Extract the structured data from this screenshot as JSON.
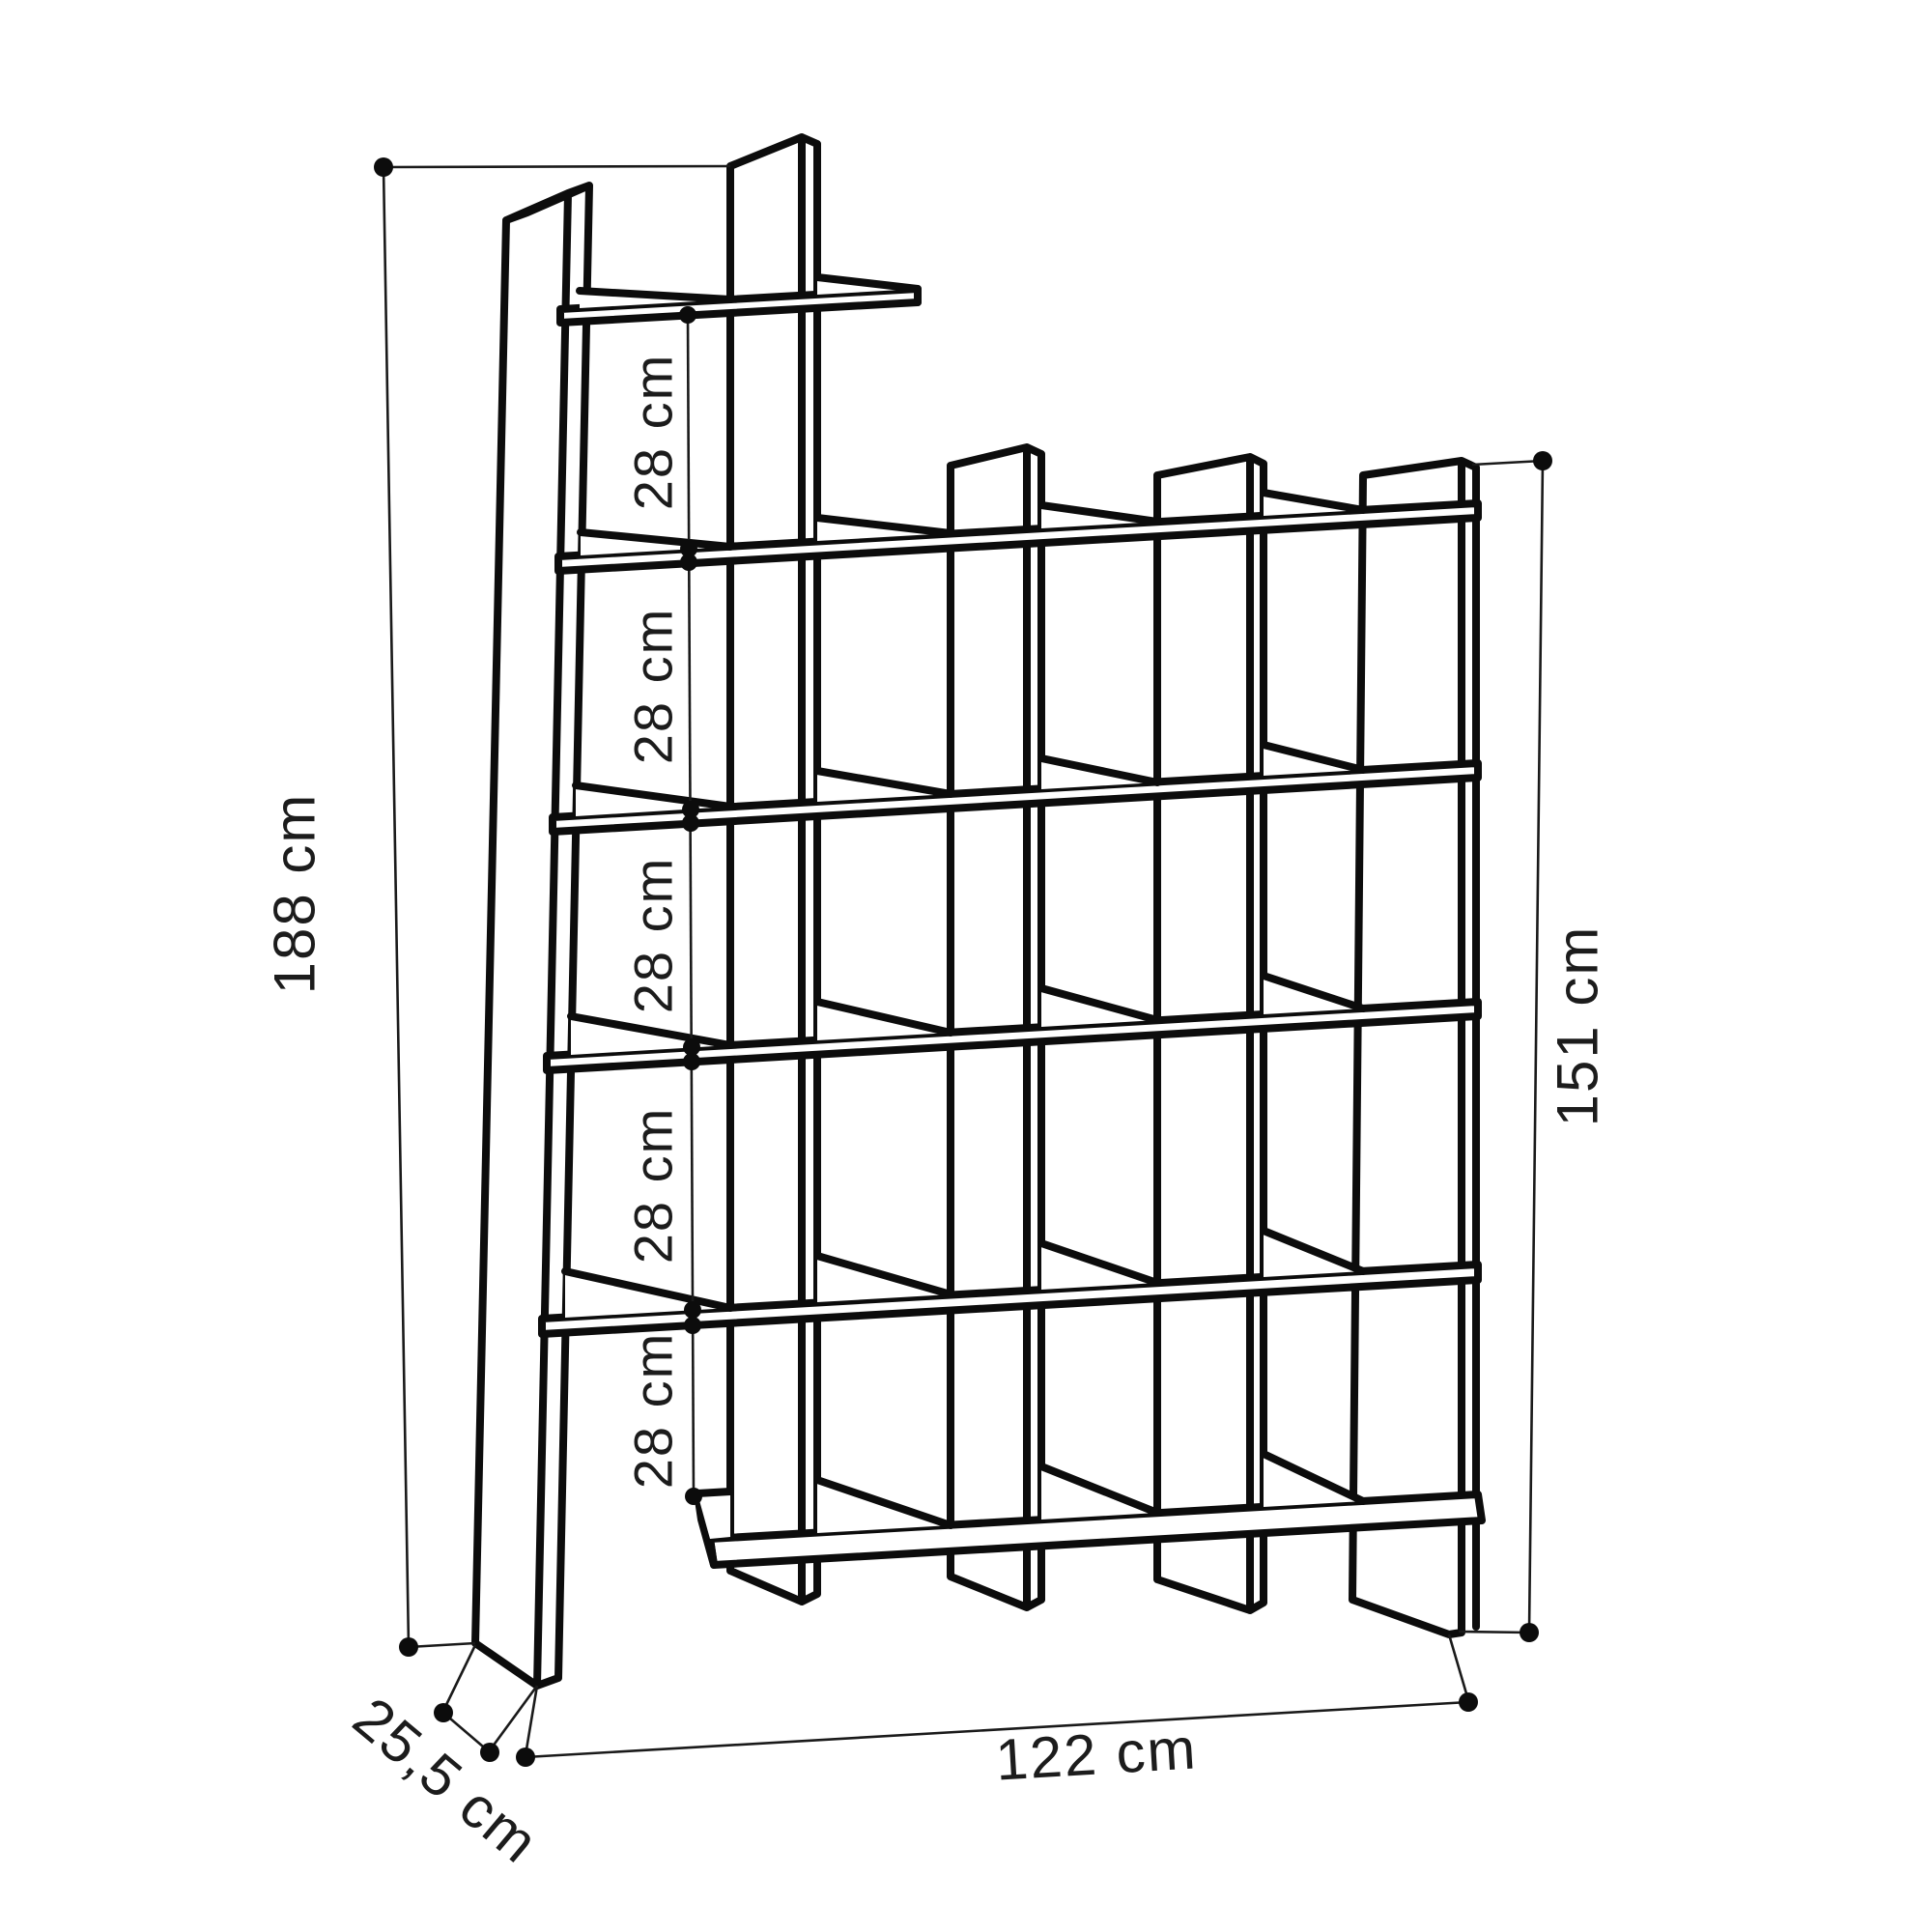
{
  "dimensions": {
    "total_height": "188 cm",
    "right_height": "151 cm",
    "width": "122 cm",
    "depth": "25,5 cm",
    "shelf_gaps": [
      "28 cm",
      "28 cm",
      "28 cm",
      "28 cm",
      "28 cm"
    ]
  }
}
